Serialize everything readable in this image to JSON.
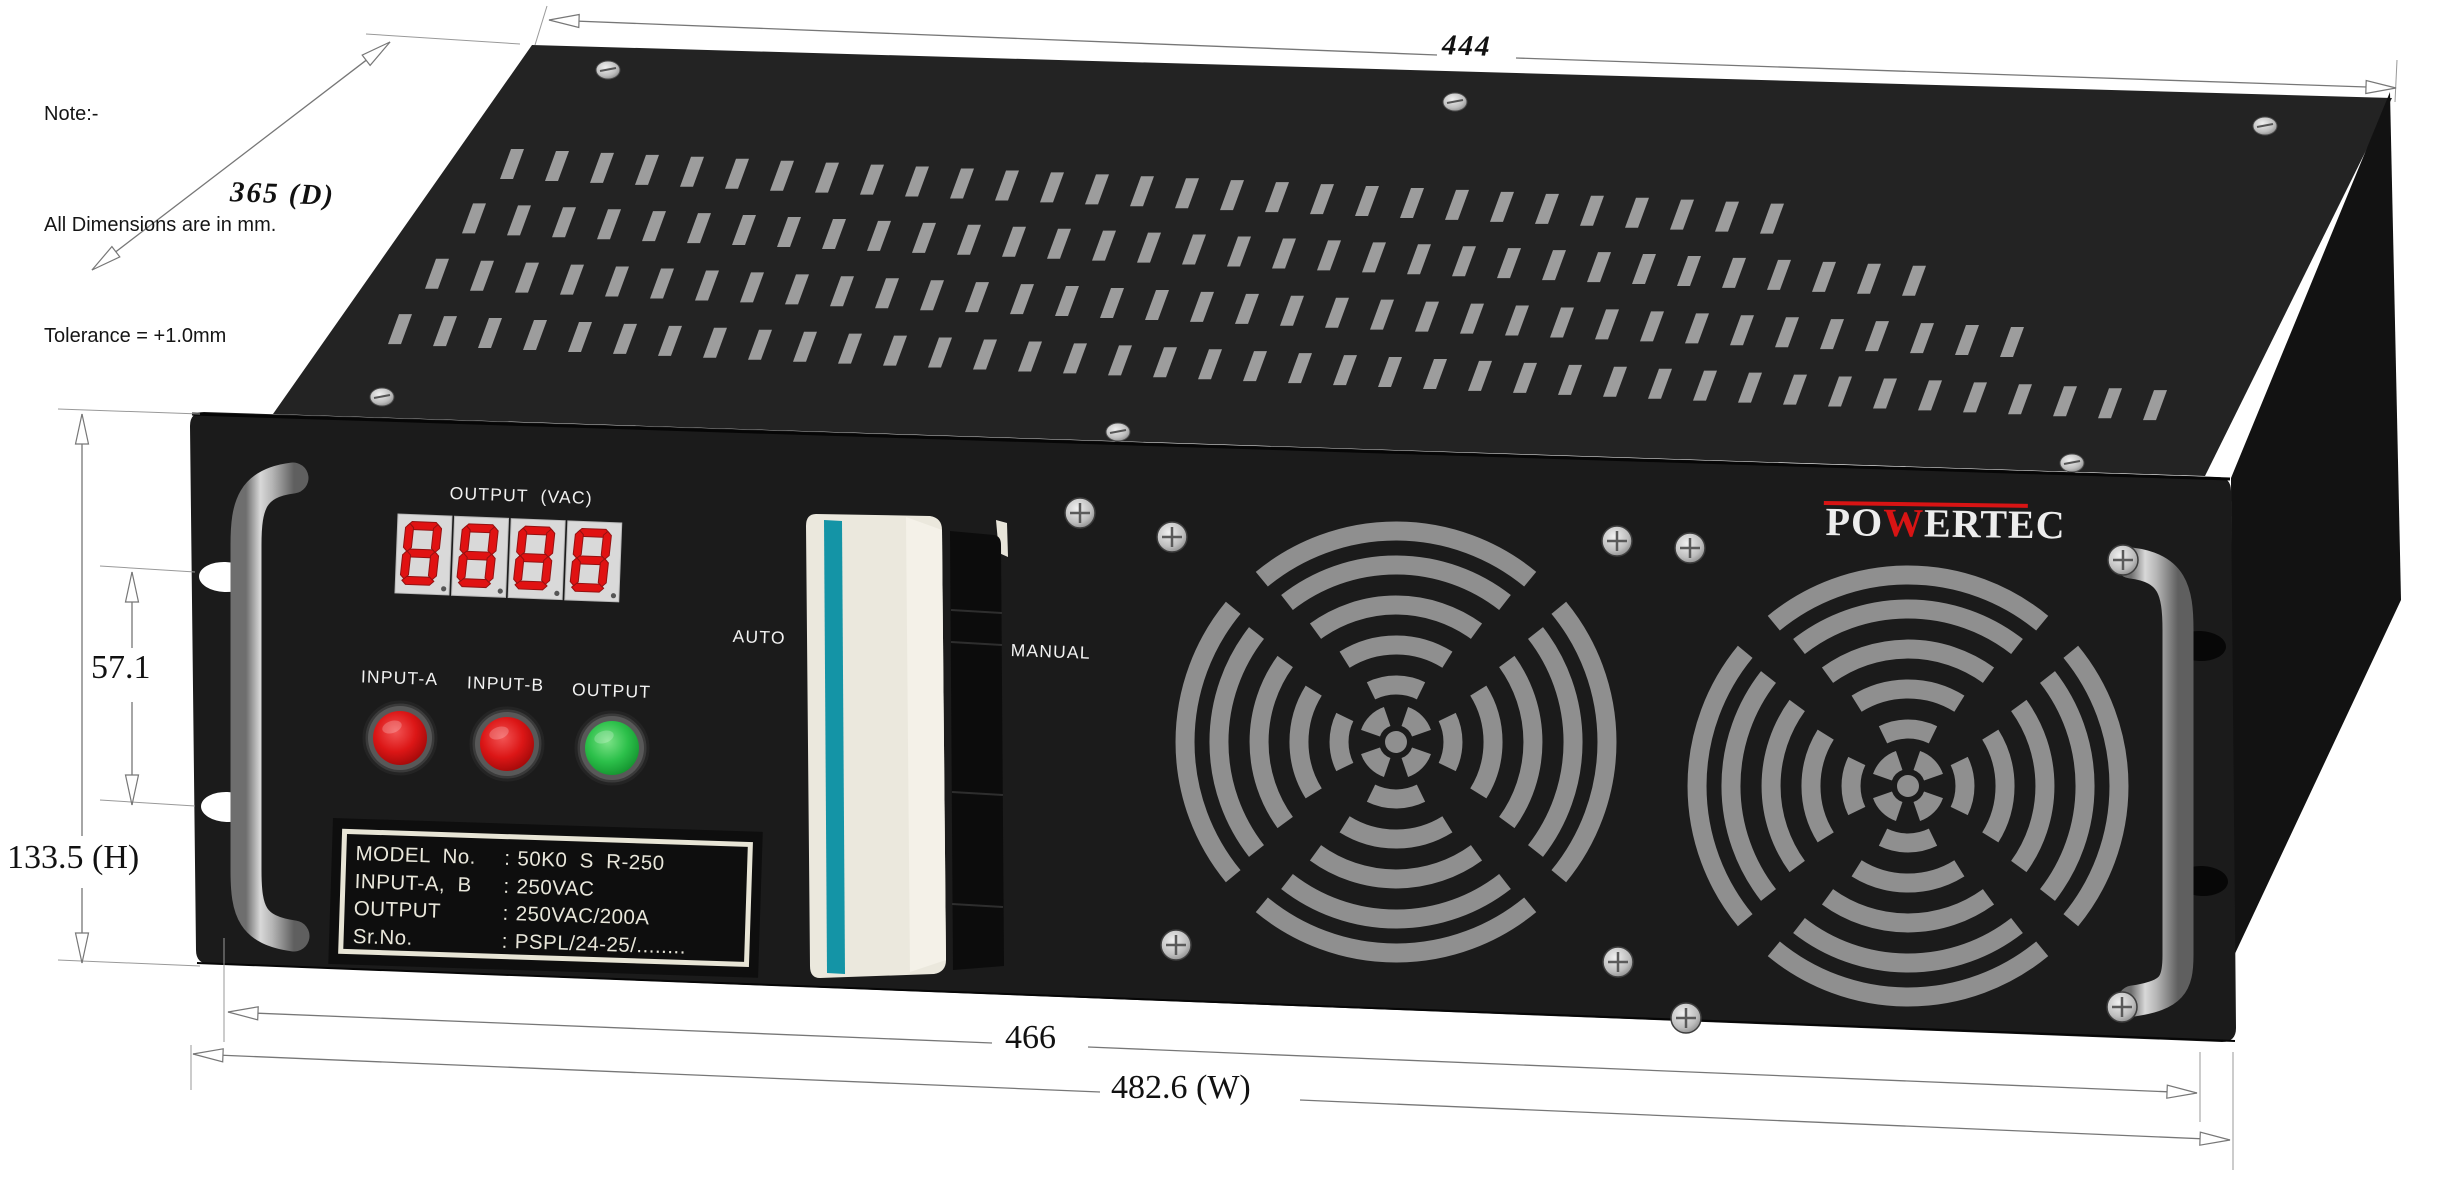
{
  "note": {
    "title": "Note:-",
    "line1": "All Dimensions are in mm.",
    "line2": "Tolerance = +1.0mm"
  },
  "dimensions": {
    "top_width_mm": "444",
    "depth_mm": "365 (D)",
    "rack_hole_spacing_mm": "57.1",
    "height_mm": "133.5 (H)",
    "panel_inner_width_mm": "466",
    "overall_width_mm": "482.6 (W)"
  },
  "front_panel": {
    "display_label": "OUTPUT  (VAC)",
    "display_digits": "8888",
    "indicator_a": "INPUT-A",
    "indicator_b": "INPUT-B",
    "indicator_out": "OUTPUT",
    "switch_left": "AUTO",
    "switch_right": "MANUAL",
    "brand_prefix": "PO",
    "brand_mark": "W",
    "brand_suffix": "ERTEC",
    "nameplate": {
      "rows": [
        {
          "label": "MODEL  No.",
          "sep": ":",
          "value": "50K0  S  R-250"
        },
        {
          "label": "INPUT-A,  B",
          "sep": ":",
          "value": "250VAC"
        },
        {
          "label": "OUTPUT",
          "sep": ":",
          "value": "250VAC/200A"
        },
        {
          "label": "Sr.No.",
          "sep": ":",
          "value": "PSPL/24-25/........"
        }
      ]
    }
  },
  "colors": {
    "brand_red": "#d81414",
    "led_red": "#d81414",
    "led_green": "#2cc04a",
    "switch_teal": "#1494a6",
    "vent_gray": "#9d9d9d"
  }
}
